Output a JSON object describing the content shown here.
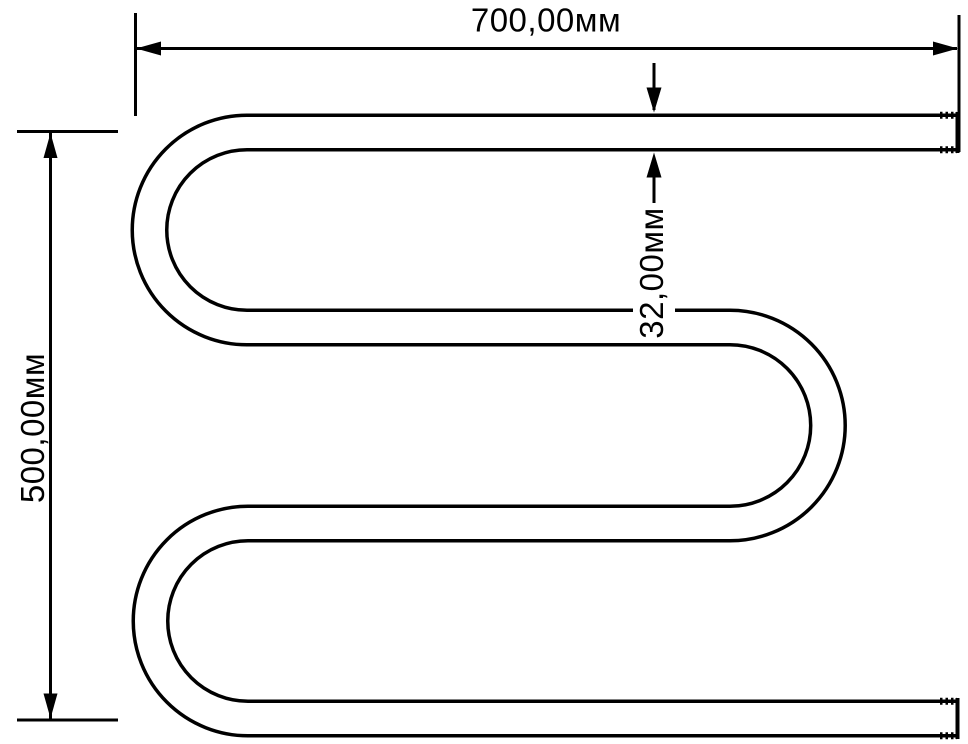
{
  "diagram": {
    "type": "technical-drawing",
    "subject": "serpentine towel-rail pipe with dimension callouts",
    "background_color": "#ffffff",
    "line_color": "#000000",
    "labels": {
      "width": "700,00мм",
      "height": "500,00мм",
      "diameter": "32,00мм"
    }
  }
}
